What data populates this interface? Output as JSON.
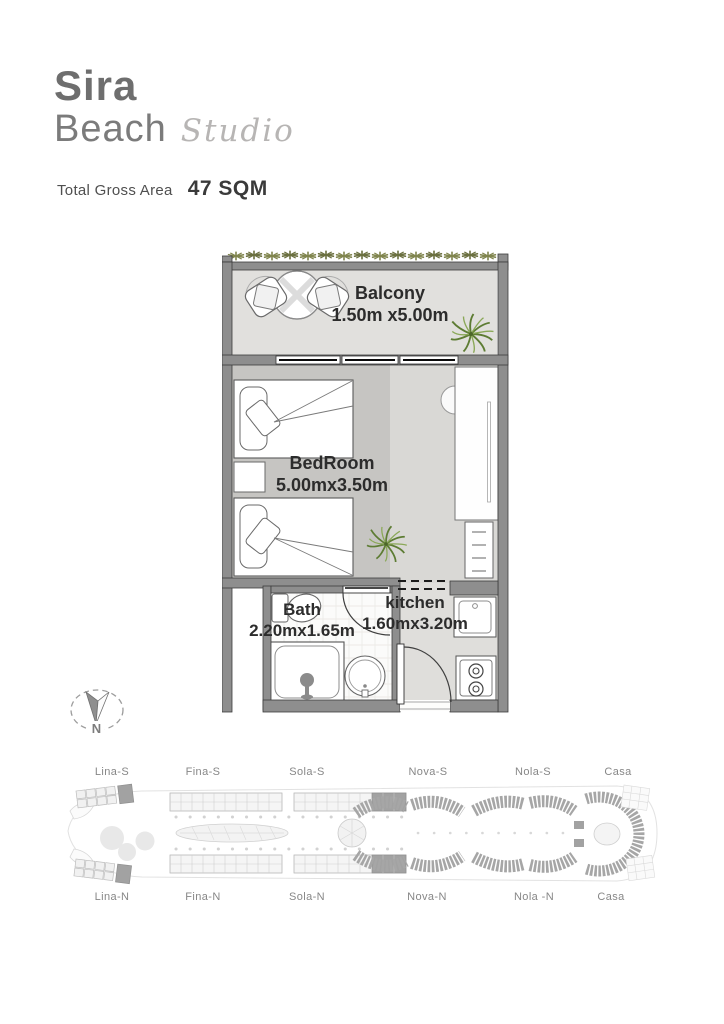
{
  "header": {
    "title_line1": "Sira",
    "title_line2": "Beach",
    "title_script": "Studio",
    "area_label": "Total Gross Area",
    "area_value": "47 SQM"
  },
  "floorplan": {
    "balcony": {
      "name": "Balcony",
      "dims": "1.50m x5.00m"
    },
    "bedroom": {
      "name": "BedRoom",
      "dims": "5.00mx3.50m"
    },
    "bath": {
      "name": "Bath",
      "dims": "2.20mx1.65m"
    },
    "kitchen": {
      "name": "kitchen",
      "dims": "1.60mx3.20m"
    }
  },
  "compass": {
    "north_label": "N"
  },
  "siteplan": {
    "top_labels": [
      "Lina-S",
      "Fina-S",
      "Sola-S",
      "Nova-S",
      "Nola-S",
      "Casa"
    ],
    "bottom_labels": [
      "Lina-N",
      "Fina-N",
      "Sola-N",
      "Nova-N",
      "Nola -N",
      "Casa"
    ]
  },
  "colors": {
    "wall": "#8e8e8e",
    "balcony_floor": "#e1e0dd",
    "bedroom_floor": "#c6c5c2",
    "corridor_floor": "#d9d8d5",
    "kitchen_floor": "#dfdedb",
    "bath_floor": "#fbfbfa",
    "plant_green": "#5d7c33",
    "hedge_green": "#80854e",
    "label_text": "#2c2c2c"
  }
}
